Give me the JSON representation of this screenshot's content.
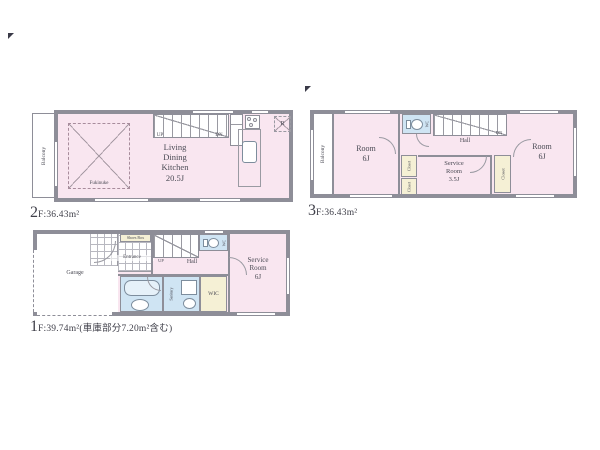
{
  "colors": {
    "room_pink": "#f9e6f0",
    "wet_blue": "#cfe4f3",
    "storage_yellow": "#f5f0d5",
    "wall_gray": "#8e8e98",
    "text": "#4a4a54"
  },
  "floor2": {
    "area_big": "2",
    "area_rest": "F:36.43m²",
    "balcony": "Balcony",
    "void_label": "Fukinuke",
    "ldk": "Living\nDining\nKitchen\n20.5J",
    "up": "UP",
    "dn": "DN",
    "refrigerator": "R"
  },
  "floor3": {
    "area_big": "3",
    "area_rest": "F:36.43m²",
    "balcony": "Balcony",
    "room_left": "Room\n6J",
    "room_right": "Room\n6J",
    "wc": "WC",
    "hall": "Hall",
    "dn": "DN",
    "service_room": "Service\nRoom\n3.5J",
    "closet": "Closet"
  },
  "floor1": {
    "area_big": "1",
    "area_rest": "F:39.74m²(車庫部分7.20m²含む)",
    "garage": "Garage",
    "shoes_box": "Shoes Box",
    "entrance": "Entrance",
    "up": "UP",
    "hall": "Hall",
    "wc": "WC",
    "sanitary": "Sanitary",
    "wic": "WIC",
    "service_room": "Service\nRoom\n6J"
  }
}
